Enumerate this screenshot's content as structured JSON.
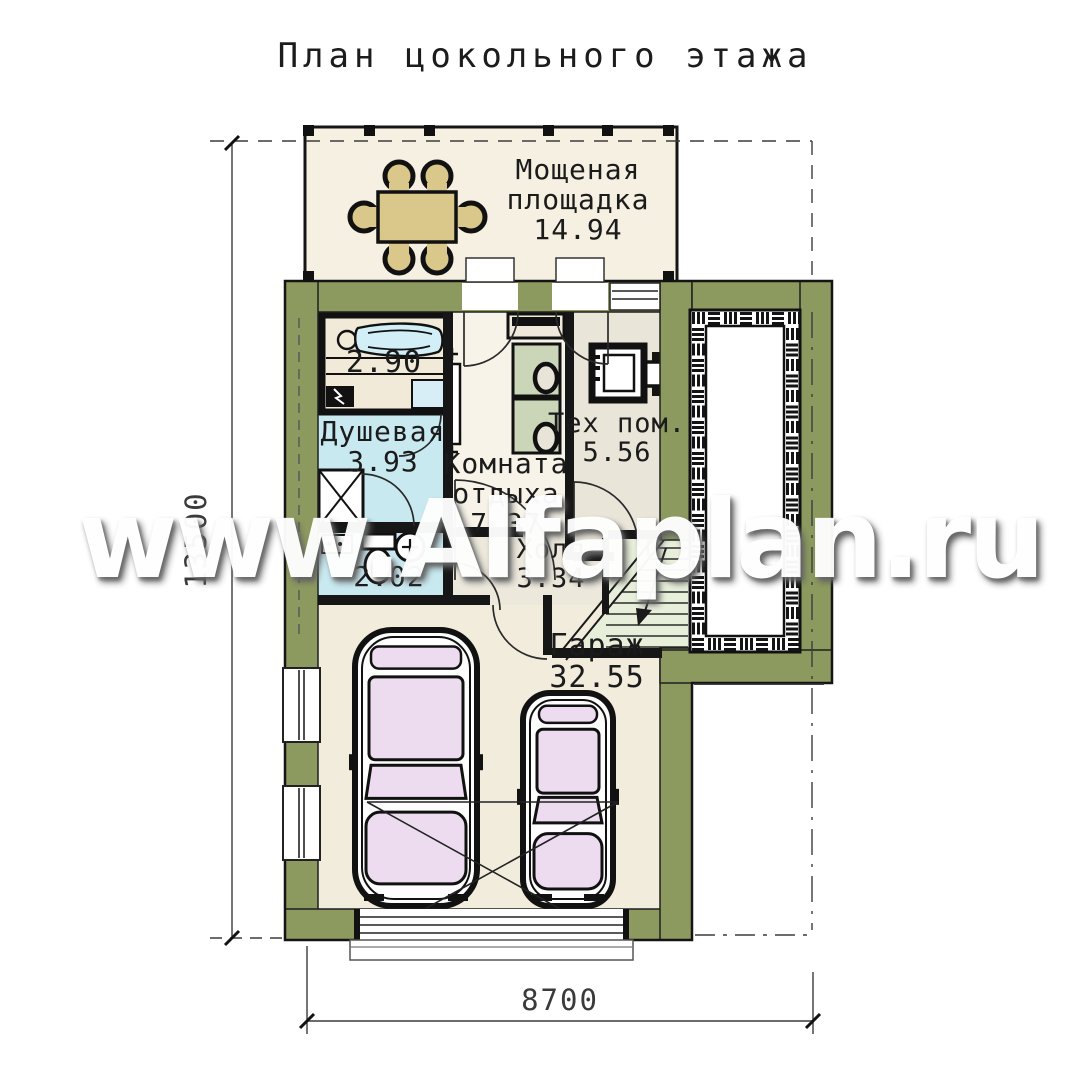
{
  "title": "План цокольного этажа",
  "watermark": "www.Alfaplan.ru",
  "rooms": {
    "terrace": {
      "name": "Мощеная площадка",
      "area": "14.94"
    },
    "sauna": {
      "area": "2.90"
    },
    "shower": {
      "name": "Душевая",
      "area": "3.93"
    },
    "lounge": {
      "name": "Комната отдыха",
      "area": "7.37"
    },
    "tech": {
      "name": "Тех пом.",
      "area": "5.56"
    },
    "wc": {
      "area": "2.02"
    },
    "hall": {
      "name": "Холл",
      "area": "3.34"
    },
    "garage": {
      "name": "Гараж",
      "area": "32.55"
    }
  },
  "dimensions": {
    "width": "8700",
    "height": "13500"
  },
  "colors": {
    "wall": "#8c9a5f",
    "floor_cream": "#f2ecdd",
    "terrace_cream": "#f5f0e2",
    "bath_cyan": "#c9e9f1",
    "sauna_cyan": "#bfe7f2",
    "tech_gray": "#e9e5d9",
    "hall_gray": "#ece8dc",
    "stairs_green": "#e7efdb",
    "table_tan": "#d9c88a",
    "car_glass_pink": "#eddcf0",
    "seat_green": "#cbd5b8"
  }
}
